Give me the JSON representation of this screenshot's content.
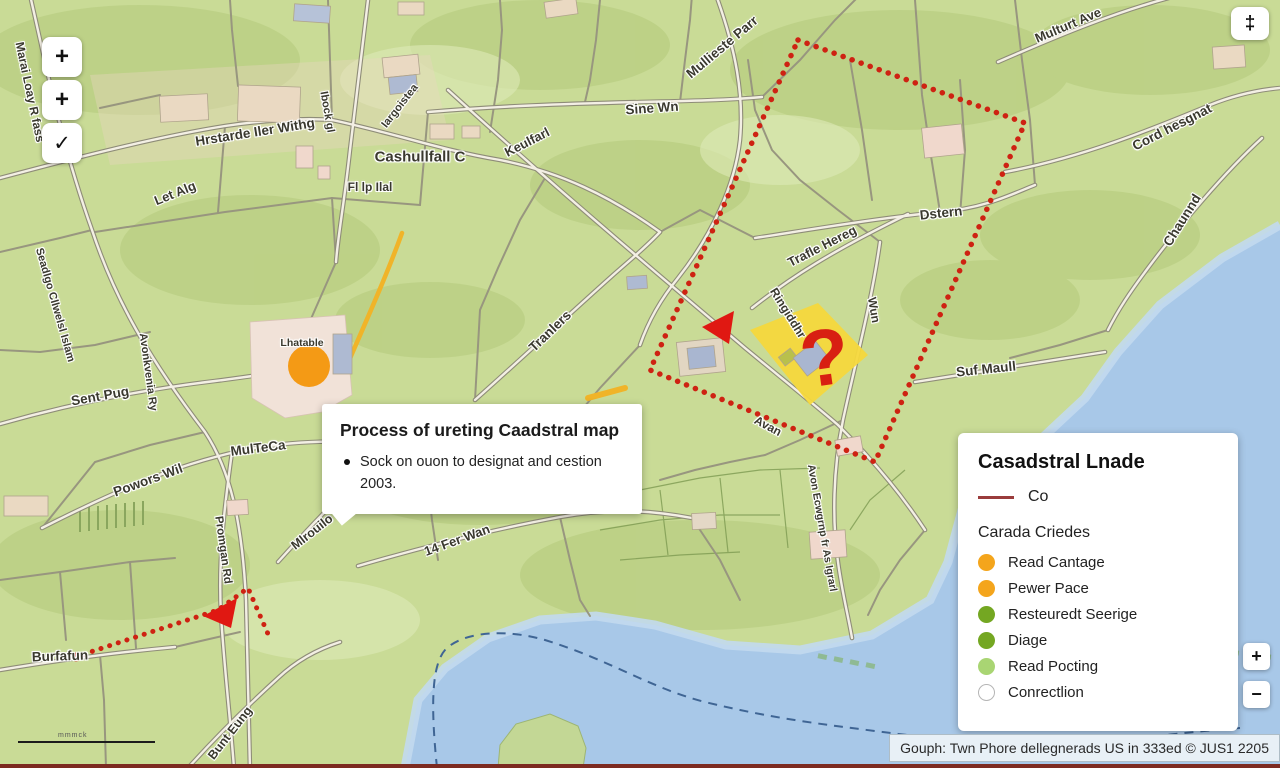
{
  "controls": {
    "zoom_in_glyph": "+",
    "zoom_in2_glyph": "+",
    "confirm_glyph": "✓",
    "locate_glyph": "‡",
    "zoom_in_small_glyph": "+",
    "zoom_out_small_glyph": "−",
    "scale_label": "mmmck"
  },
  "popup": {
    "title": "Process of ureting Caadstral map",
    "bullet": "Sock on ouon to designat and cestion 2003."
  },
  "legend": {
    "title": "Casadstral Lnade",
    "line_item": {
      "label": "Co",
      "color": "#9a3c3c"
    },
    "subtitle": "Carada Criedes",
    "items": [
      {
        "label": "Read Cantage",
        "color": "#f4a51c"
      },
      {
        "label": "Pewer Pace",
        "color": "#f4a51c"
      },
      {
        "label": "Resteuredt Seerige",
        "color": "#74a722"
      },
      {
        "label": "Diage",
        "color": "#74a722"
      },
      {
        "label": "Read Pocting",
        "color": "#a9d573"
      },
      {
        "label": "Conrectlion",
        "color": "#ffffff",
        "border": "#b5b5b5"
      }
    ]
  },
  "attribution": "Gouph: Twn Phore dellegnerads US in 333ed © JUS1 2205",
  "map": {
    "question_marker": "?",
    "colors": {
      "land": "#c9db96",
      "water": "#a8c8e8",
      "selection_red": "#ce2212",
      "highlight_yellow": "#f5d83c",
      "poi_orange": "#f49a15"
    },
    "labels": [
      {
        "text": "Marai Loay R fass",
        "x": 30,
        "y": 92,
        "rot": 78,
        "size": 12
      },
      {
        "text": "Seadlgo Cllwelsl Islam",
        "x": 55,
        "y": 305,
        "rot": 74,
        "size": 11
      },
      {
        "text": "Hrstarde Iler Withg",
        "x": 255,
        "y": 132,
        "rot": -9,
        "size": 13.5
      },
      {
        "text": "Let Alg",
        "x": 175,
        "y": 193,
        "rot": -22,
        "size": 13
      },
      {
        "text": "Ibock gl",
        "x": 327,
        "y": 112,
        "rot": 80,
        "size": 11
      },
      {
        "text": "Iargoistea",
        "x": 400,
        "y": 106,
        "rot": -52,
        "size": 11
      },
      {
        "text": "Cashullfall C",
        "x": 420,
        "y": 157,
        "rot": 0,
        "size": 15
      },
      {
        "text": "Fl lp Ilal",
        "x": 370,
        "y": 187,
        "rot": 0,
        "size": 12
      },
      {
        "text": "Mullieste Parr",
        "x": 722,
        "y": 47,
        "rot": -40,
        "size": 13.5
      },
      {
        "text": "Sine Wn",
        "x": 652,
        "y": 108,
        "rot": -4,
        "size": 13.5
      },
      {
        "text": "Keulfarl",
        "x": 527,
        "y": 142,
        "rot": -27,
        "size": 13
      },
      {
        "text": "Multurt Ave",
        "x": 1068,
        "y": 25,
        "rot": -23,
        "size": 13
      },
      {
        "text": "Cord hesgnat",
        "x": 1172,
        "y": 127,
        "rot": -27,
        "size": 13.5
      },
      {
        "text": "Chaunnd",
        "x": 1182,
        "y": 220,
        "rot": -58,
        "size": 13.5
      },
      {
        "text": "Dstern",
        "x": 941,
        "y": 213,
        "rot": -6,
        "size": 13.5
      },
      {
        "text": "Trafle Hereg",
        "x": 822,
        "y": 246,
        "rot": -27,
        "size": 13
      },
      {
        "text": "Suf Maull",
        "x": 986,
        "y": 369,
        "rot": -6,
        "size": 13.5
      },
      {
        "text": "Wun",
        "x": 874,
        "y": 310,
        "rot": 80,
        "size": 12
      },
      {
        "text": "Ringiddhr",
        "x": 788,
        "y": 313,
        "rot": 58,
        "size": 12
      },
      {
        "text": "Avan",
        "x": 768,
        "y": 426,
        "rot": 28,
        "size": 12
      },
      {
        "text": "Avon Ecwgrnp fr As Igrarl",
        "x": 822,
        "y": 528,
        "rot": 80,
        "size": 10.5
      },
      {
        "text": "Tranlers",
        "x": 550,
        "y": 331,
        "rot": -44,
        "size": 13.5
      },
      {
        "text": "Avonkvenia Ry",
        "x": 148,
        "y": 372,
        "rot": 82,
        "size": 11
      },
      {
        "text": "Sent Pug",
        "x": 100,
        "y": 396,
        "rot": -10,
        "size": 13.5
      },
      {
        "text": "MulTeCa",
        "x": 258,
        "y": 448,
        "rot": -7,
        "size": 13.5
      },
      {
        "text": "Powors Wil",
        "x": 148,
        "y": 480,
        "rot": -20,
        "size": 13.5
      },
      {
        "text": "Mlrouilo",
        "x": 312,
        "y": 532,
        "rot": -38,
        "size": 12.5
      },
      {
        "text": "Promgan Rd",
        "x": 223,
        "y": 550,
        "rot": 82,
        "size": 11.5
      },
      {
        "text": "14 Fer Wan",
        "x": 457,
        "y": 540,
        "rot": -20,
        "size": 13
      },
      {
        "text": "Burfafun",
        "x": 60,
        "y": 656,
        "rot": -2,
        "size": 13.5
      },
      {
        "text": "Bunt Eung",
        "x": 230,
        "y": 733,
        "rot": -52,
        "size": 12.5
      },
      {
        "text": "Lhatable",
        "x": 302,
        "y": 343,
        "rot": 0,
        "size": 10.5
      }
    ]
  }
}
